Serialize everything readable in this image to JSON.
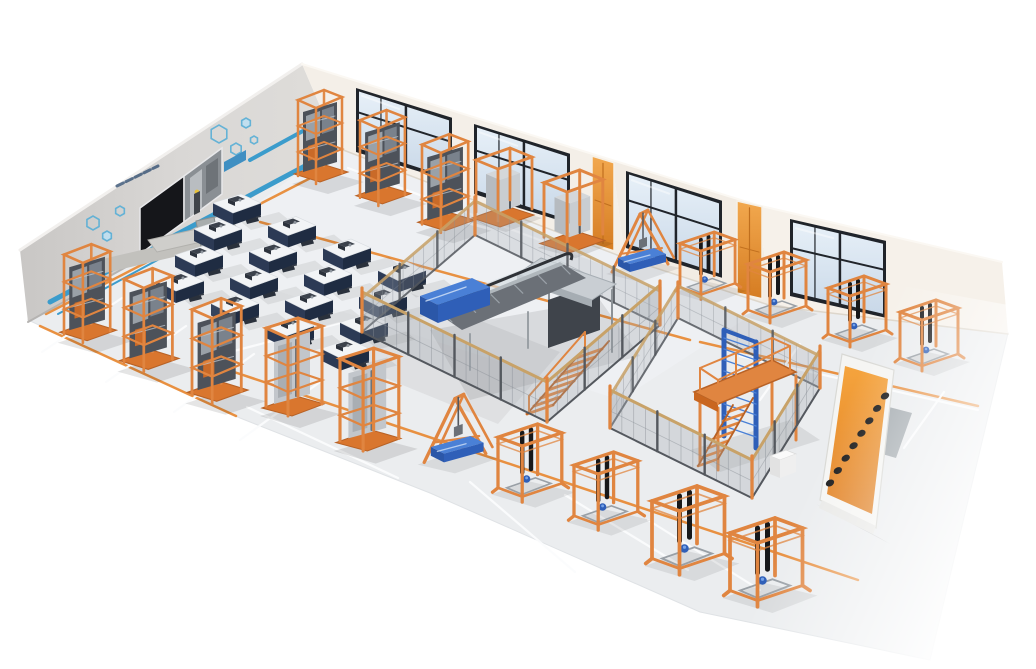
{
  "meta": {
    "scene_type": "isometric-3d-render",
    "subject": "elevator-escalator-training-workshop",
    "legible_text": false
  },
  "colors": {
    "bg": "#ffffff",
    "floor": "#ebedef",
    "floor_line_white": "#fbfcfd",
    "floor_line_orange": "#e8872f",
    "wall_left": "#d7d5d3",
    "wall_left_dark": "#c7c5c3",
    "wall_north": "#f4efe8",
    "wall_north2": "#f2ece4",
    "wall_east": "#f6f1ea",
    "window_frame": "#20242a",
    "window_pane": "#dce8f4",
    "door_orange": "#e8923c",
    "frame_orange": "#e08540",
    "frame_orange_dark": "#b86226",
    "frame_base": "#d9762e",
    "machinery_dark": "#4d525a",
    "machinery_gray": "#9aa1a8",
    "car_gray": "#c2c6cb",
    "blue_machine": "#2f5fb8",
    "blue_machine_light": "#4a80d6",
    "blue_machine_dark": "#2b57a8",
    "fence_mesh": "#9fa6ac",
    "fence_post": "#54585e",
    "fence_rail_tan": "#c8a268",
    "stripe_blue": "#3b9ccc",
    "hex_blue": "#58aed6",
    "screen_black": "#15161a",
    "desk_top": "#f2f4f6",
    "desk_front": "#2c3a55",
    "desk_side": "#1f2c42",
    "sign_orange": "#f09a36",
    "sign_glyph": "#141414",
    "truss_gray": "#6b7077",
    "canopy_gray": "#c9ced3"
  },
  "scene": {
    "canvas": {
      "w": 1036,
      "h": 669
    },
    "floor": {
      "outline": [
        [
          28,
          320
        ],
        [
          335,
          146
        ],
        [
          770,
          303
        ],
        [
          1008,
          333
        ],
        [
          930,
          660
        ],
        [
          700,
          612
        ],
        [
          430,
          493
        ],
        [
          240,
          418
        ]
      ],
      "classroom_shadow": [
        [
          408,
          292
        ],
        [
          560,
          352
        ],
        [
          498,
          424
        ],
        [
          346,
          362
        ]
      ]
    },
    "walls": {
      "left": {
        "pts": [
          [
            20,
            250
          ],
          [
            302,
            64
          ],
          [
            338,
            148
          ],
          [
            28,
            322
          ]
        ]
      },
      "northA": {
        "pts": [
          [
            302,
            64
          ],
          [
            612,
            160
          ],
          [
            625,
            258
          ],
          [
            338,
            148
          ]
        ]
      },
      "northB": {
        "pts": [
          [
            612,
            160
          ],
          [
            757,
            205
          ],
          [
            772,
            306
          ],
          [
            625,
            258
          ]
        ]
      },
      "east": {
        "pts": [
          [
            757,
            205
          ],
          [
            1002,
            262
          ],
          [
            1008,
            334
          ],
          [
            772,
            306
          ]
        ]
      }
    },
    "media_wall": {
      "stripes": [
        {
          "a": [
            50,
            302
          ],
          "b": [
            335,
            150
          ],
          "w": 5
        },
        {
          "a": [
            58,
            314
          ],
          "b": [
            198,
            238
          ],
          "w": 2
        },
        {
          "a": [
            250,
            160
          ],
          "b": [
            312,
            126
          ],
          "w": 4
        }
      ],
      "hexagons": [
        [
          93,
          223,
          7,
          0
        ],
        [
          107,
          236,
          5,
          1
        ],
        [
          120,
          211,
          5,
          0
        ],
        [
          219,
          134,
          9,
          0
        ],
        [
          236,
          149,
          6,
          0
        ],
        [
          246,
          123,
          5,
          1
        ],
        [
          254,
          140,
          4,
          0
        ]
      ],
      "screen_black": [
        [
          140,
          208
        ],
        [
          184,
          176
        ],
        [
          184,
          222
        ],
        [
          140,
          254
        ]
      ],
      "screen_video": [
        [
          184,
          176
        ],
        [
          222,
          148
        ],
        [
          222,
          194
        ],
        [
          184,
          222
        ]
      ],
      "blue_patch": [
        [
          224,
          162
        ],
        [
          246,
          150
        ],
        [
          246,
          160
        ],
        [
          224,
          172
        ]
      ],
      "label_dash": {
        "a": [
          117,
          186
        ],
        "b": [
          158,
          166
        ]
      },
      "console": [
        [
          148,
          240
        ],
        [
          232,
          221
        ],
        [
          241,
          233
        ],
        [
          157,
          252
        ]
      ],
      "mat": [
        [
          90,
          262
        ],
        [
          205,
          235
        ],
        [
          216,
          247
        ],
        [
          101,
          274
        ]
      ],
      "lectern": [
        [
          196,
          221
        ],
        [
          214,
          217
        ],
        [
          219,
          243
        ],
        [
          201,
          247
        ]
      ]
    },
    "windows": [
      {
        "x": 356,
        "y": 88,
        "w": 96,
        "h": 64,
        "slope": 0.31
      },
      {
        "x": 474,
        "y": 124,
        "w": 96,
        "h": 70,
        "slope": 0.31
      },
      {
        "x": 626,
        "y": 171,
        "w": 96,
        "h": 77,
        "slope": 0.31
      },
      {
        "x": 790,
        "y": 219,
        "w": 96,
        "h": 77,
        "slope": 0.228
      }
    ],
    "doors": [
      {
        "x": 592,
        "y": 156,
        "w": 22,
        "h": 88,
        "slope": 0.31
      },
      {
        "x": 737,
        "y": 201,
        "w": 25,
        "h": 92,
        "slope": 0.23
      }
    ],
    "classroom": {
      "rows": 4,
      "cols": 4,
      "origin": [
        237,
        208
      ],
      "u": [
        55,
        22.5
      ],
      "v": [
        -19,
        26
      ]
    },
    "equipment": {
      "towers": [
        [
          298,
          88,
          1.0
        ],
        [
          360,
          108,
          1.02
        ],
        [
          422,
          132,
          1.05
        ],
        [
          64,
          242,
          1.05
        ],
        [
          124,
          266,
          1.1
        ],
        [
          192,
          296,
          1.12
        ]
      ],
      "cube_cars": [
        [
          476,
          148,
          1.0
        ],
        [
          544,
          170,
          1.05
        ]
      ],
      "racks": [
        [
          266,
          316,
          1.0
        ],
        [
          340,
          346,
          1.05
        ]
      ],
      "a_frames": [
        [
          610,
          208,
          1.0
        ],
        [
          422,
          392,
          1.1
        ]
      ],
      "portal_frames": [
        [
          748,
          252,
          1.0
        ],
        [
          828,
          276,
          1.0
        ],
        [
          900,
          300,
          1.0
        ],
        [
          680,
          232,
          0.95
        ],
        [
          498,
          424,
          1.1
        ],
        [
          574,
          452,
          1.1
        ],
        [
          652,
          486,
          1.25
        ],
        [
          730,
          518,
          1.25
        ]
      ]
    },
    "cages": [
      {
        "name": "escalator-training-cage",
        "W": [
          362,
          332
        ],
        "N": [
          475,
          235
        ],
        "E": [
          660,
          325
        ],
        "S": [
          547,
          422
        ],
        "h_back": 34,
        "h_front": 40
      },
      {
        "name": "lift-platform-training-cage",
        "W": [
          610,
          428
        ],
        "N": [
          678,
          318
        ],
        "E": [
          820,
          388
        ],
        "S": [
          752,
          498
        ],
        "h_back": 32,
        "h_front": 38
      }
    ],
    "escalator": {
      "x": 420,
      "y": 248
    },
    "platform_tower": {
      "x": 690,
      "y": 328
    },
    "markings": {
      "white": [
        [
          [
            122,
            298
          ],
          [
            42,
            352
          ]
        ],
        [
          [
            186,
            326
          ],
          [
            106,
            382
          ]
        ],
        [
          [
            254,
            354
          ],
          [
            174,
            412
          ]
        ],
        [
          [
            320,
            382
          ],
          [
            240,
            440
          ]
        ],
        [
          [
            215,
            356
          ],
          [
            340,
            323
          ]
        ],
        [
          [
            247,
            407
          ],
          [
            398,
            478
          ]
        ],
        [
          [
            348,
            168
          ],
          [
            630,
            274
          ]
        ],
        [
          [
            470,
            482
          ],
          [
            575,
            572
          ]
        ],
        [
          [
            565,
            495
          ],
          [
            688,
            570
          ]
        ],
        [
          [
            648,
            520
          ],
          [
            760,
            590
          ]
        ],
        [
          [
            740,
            356
          ],
          [
            978,
            410
          ]
        ],
        [
          [
            800,
            344
          ],
          [
            760,
            400
          ]
        ],
        [
          [
            872,
            368
          ],
          [
            832,
            424
          ]
        ],
        [
          [
            944,
            392
          ],
          [
            904,
            448
          ]
        ]
      ],
      "orange": [
        [
          [
            46,
            314
          ],
          [
            330,
            168
          ]
        ],
        [
          [
            40,
            326
          ],
          [
            236,
            416
          ]
        ],
        [
          [
            228,
            370
          ],
          [
            858,
            580
          ]
        ],
        [
          [
            260,
            222
          ],
          [
            690,
            340
          ]
        ],
        [
          [
            700,
            342
          ],
          [
            978,
            406
          ]
        ]
      ]
    },
    "extras": {
      "sign": {
        "board": [
          [
            842,
            354
          ],
          [
            894,
            370
          ],
          [
            876,
            528
          ],
          [
            820,
            500
          ]
        ],
        "face": [
          [
            845,
            366
          ],
          [
            888,
            379
          ],
          [
            872,
            514
          ],
          [
            827,
            494
          ]
        ],
        "glyph_a": [
          830,
          483
        ],
        "glyph_b": [
          885,
          396
        ],
        "glyph_n": 8
      },
      "mat": [
        [
          862,
          400
        ],
        [
          912,
          413
        ],
        [
          896,
          458
        ],
        [
          847,
          444
        ]
      ],
      "pedestal": {
        "x": 770,
        "y": 450
      }
    }
  }
}
